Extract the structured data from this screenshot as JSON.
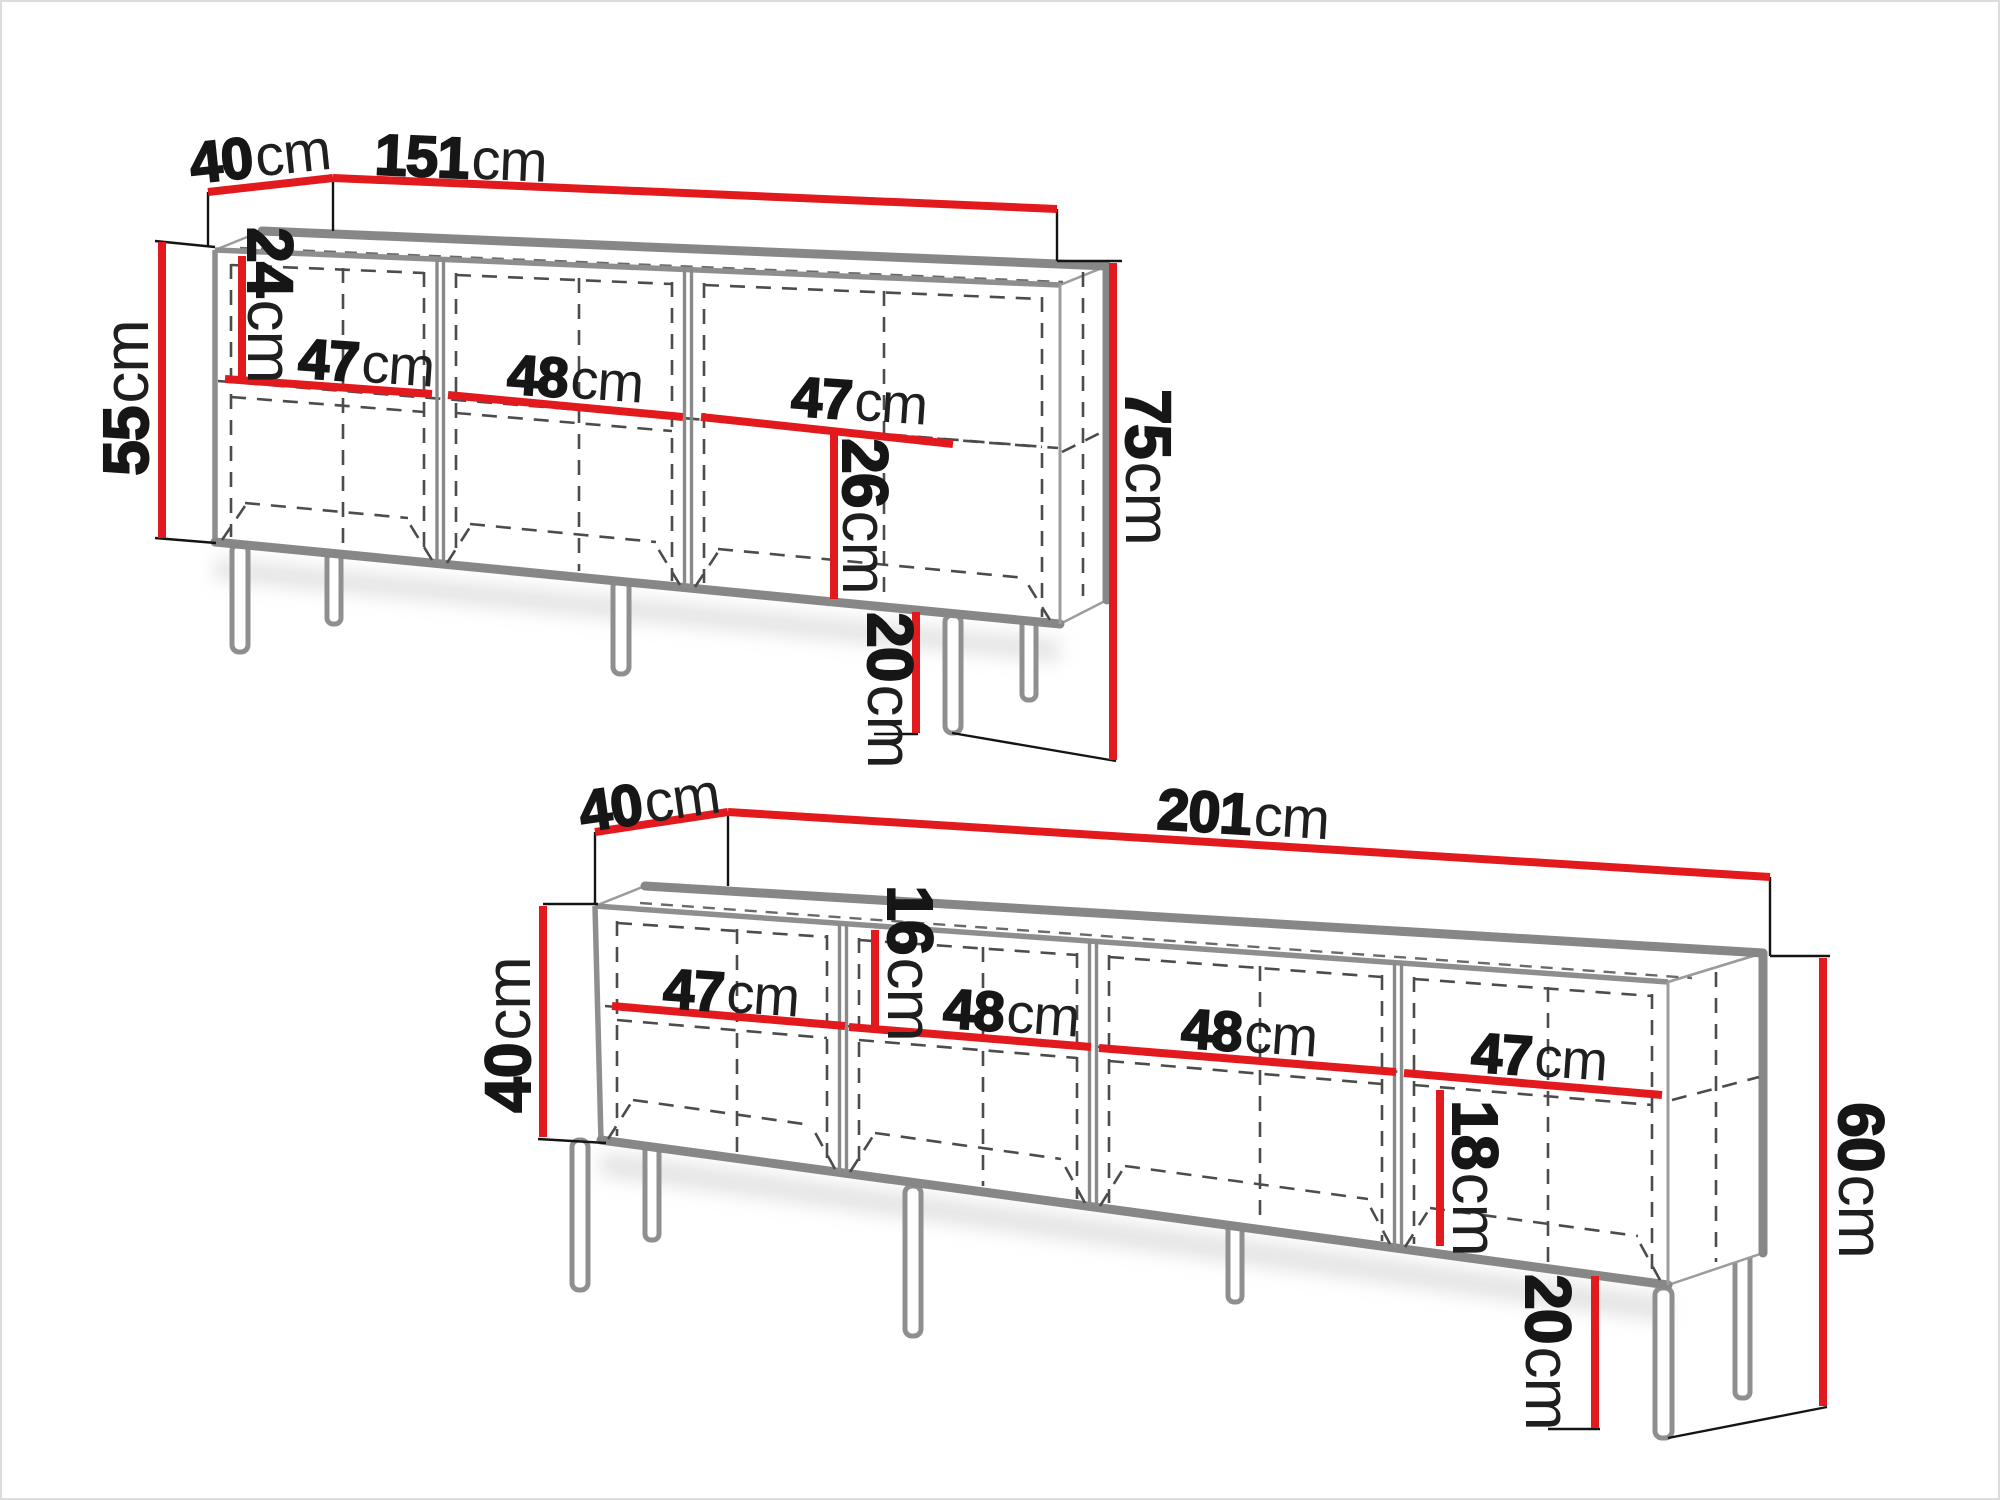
{
  "colors": {
    "dimension_red": "#e2191d",
    "cabinet_gray": "#8a8a8a",
    "text_black": "#161616"
  },
  "top_unit": {
    "name": "sideboard-151cm",
    "dims": {
      "depth": {
        "v": "40",
        "u": "cm"
      },
      "width": {
        "v": "151",
        "u": "cm"
      },
      "body_height": {
        "v": "55",
        "u": "cm"
      },
      "upper_inner_height": {
        "v": "24",
        "u": "cm"
      },
      "comp1_width": {
        "v": "47",
        "u": "cm"
      },
      "comp2_width": {
        "v": "48",
        "u": "cm"
      },
      "comp3_width": {
        "v": "47",
        "u": "cm"
      },
      "lower_inner_height": {
        "v": "26",
        "u": "cm"
      },
      "leg_height": {
        "v": "20",
        "u": "cm"
      },
      "total_height": {
        "v": "75",
        "u": "cm"
      }
    }
  },
  "bottom_unit": {
    "name": "tv-stand-201cm",
    "dims": {
      "depth": {
        "v": "40",
        "u": "cm"
      },
      "width": {
        "v": "201",
        "u": "cm"
      },
      "body_height": {
        "v": "40",
        "u": "cm"
      },
      "upper_inner_height": {
        "v": "16",
        "u": "cm"
      },
      "comp1_width": {
        "v": "47",
        "u": "cm"
      },
      "comp2_width": {
        "v": "48",
        "u": "cm"
      },
      "comp3_width": {
        "v": "48",
        "u": "cm"
      },
      "comp4_width": {
        "v": "47",
        "u": "cm"
      },
      "lower_inner_height": {
        "v": "18",
        "u": "cm"
      },
      "leg_height": {
        "v": "20",
        "u": "cm"
      },
      "total_height": {
        "v": "60",
        "u": "cm"
      }
    }
  }
}
